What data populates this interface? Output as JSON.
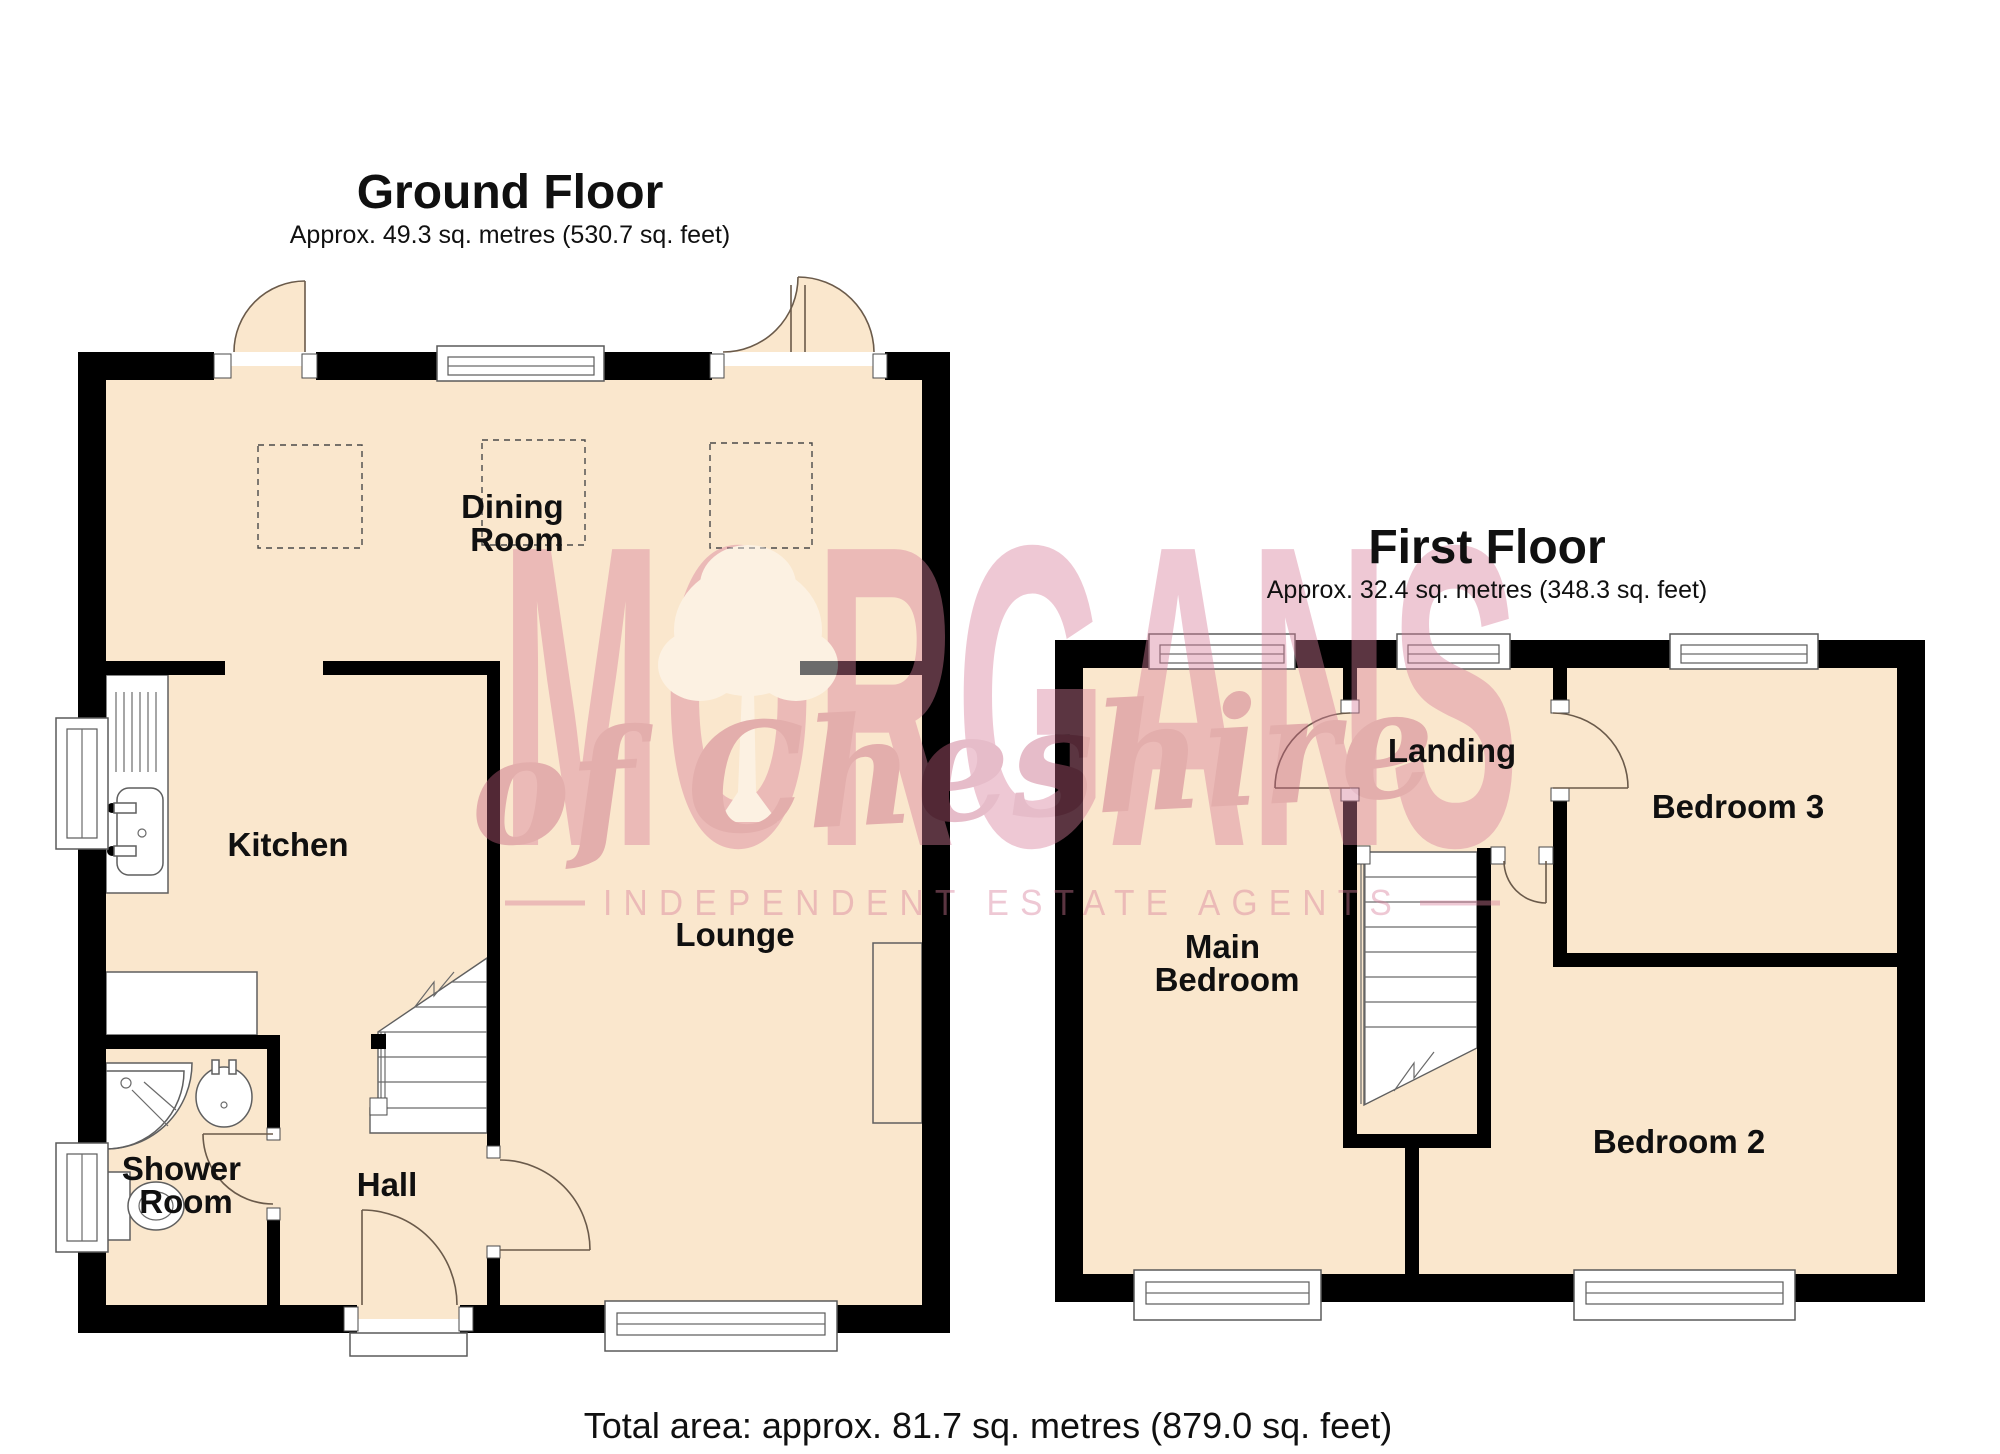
{
  "page": {
    "background": "#ffffff"
  },
  "colors": {
    "floor_fill": "#fae7cd",
    "wall": "#000000",
    "fixture_outline": "#5f5f5f",
    "watermark_pink": "#d87e9b",
    "watermark_script": "#c4617f",
    "label_color": "#101010"
  },
  "ground_floor": {
    "title": "Ground Floor",
    "subtitle": "Approx. 49.3 sq. metres (530.7 sq. feet)",
    "rooms": [
      {
        "id": "dining-room",
        "lines": [
          "Dining",
          "Room"
        ]
      },
      {
        "id": "kitchen",
        "lines": [
          "Kitchen"
        ]
      },
      {
        "id": "lounge",
        "lines": [
          "Lounge"
        ]
      },
      {
        "id": "shower-room",
        "lines": [
          "Shower",
          "Room"
        ]
      },
      {
        "id": "hall",
        "lines": [
          "Hall"
        ]
      }
    ]
  },
  "first_floor": {
    "title": "First Floor",
    "subtitle": "Approx. 32.4 sq. metres (348.3 sq. feet)",
    "rooms": [
      {
        "id": "landing",
        "lines": [
          "Landing"
        ]
      },
      {
        "id": "main-bedroom",
        "lines": [
          "Main",
          "Bedroom"
        ]
      },
      {
        "id": "bedroom-3",
        "lines": [
          "Bedroom 3"
        ]
      },
      {
        "id": "bedroom-2",
        "lines": [
          "Bedroom 2"
        ]
      }
    ]
  },
  "watermark": {
    "brand": "MORGANS",
    "sub_brand": "of Cheshire",
    "tagline": "INDEPENDENT ESTATE AGENTS"
  },
  "footer": {
    "total_area": "Total area: approx. 81.7 sq. metres (879.0 sq. feet)"
  }
}
